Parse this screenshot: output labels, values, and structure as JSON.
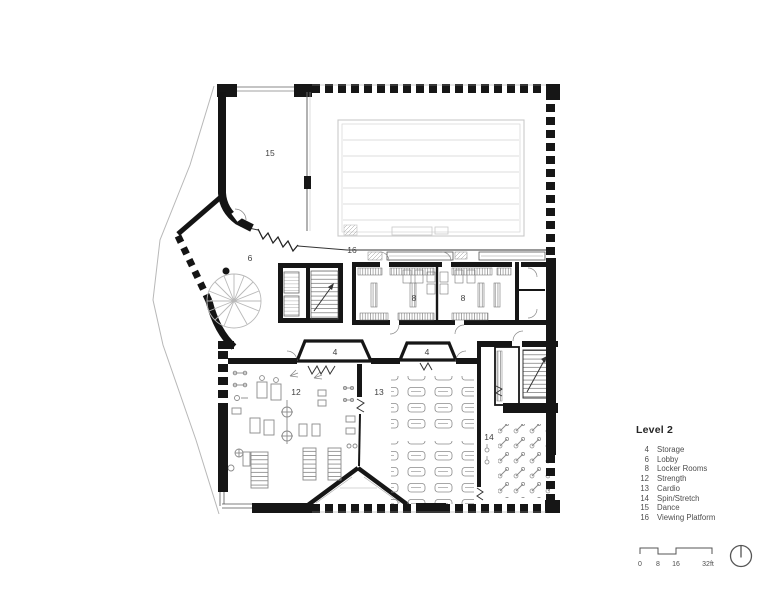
{
  "legend": {
    "heading": "Level 2",
    "items": [
      {
        "num": "4",
        "label": "Storage"
      },
      {
        "num": "6",
        "label": "Lobby"
      },
      {
        "num": "8",
        "label": "Locker Rooms"
      },
      {
        "num": "12",
        "label": "Strength"
      },
      {
        "num": "13",
        "label": "Cardio"
      },
      {
        "num": "14",
        "label": "Spin/Stretch"
      },
      {
        "num": "15",
        "label": "Dance"
      },
      {
        "num": "16",
        "label": "Viewing Platform"
      }
    ]
  },
  "plan_labels": {
    "dance": "15",
    "lobby": "6",
    "viewing_platform": "16",
    "locker_left": "8",
    "locker_right": "8",
    "storage_left": "4",
    "storage_right": "4",
    "strength": "12",
    "cardio": "13",
    "spin": "14"
  },
  "scale_bar": {
    "ticks": [
      "0",
      "8",
      "16",
      "32ft"
    ]
  },
  "colors": {
    "ink": "#161616",
    "text": "#4a4a4a",
    "light_line": "#c9c9c9",
    "equipment": "#8a8a8a"
  }
}
